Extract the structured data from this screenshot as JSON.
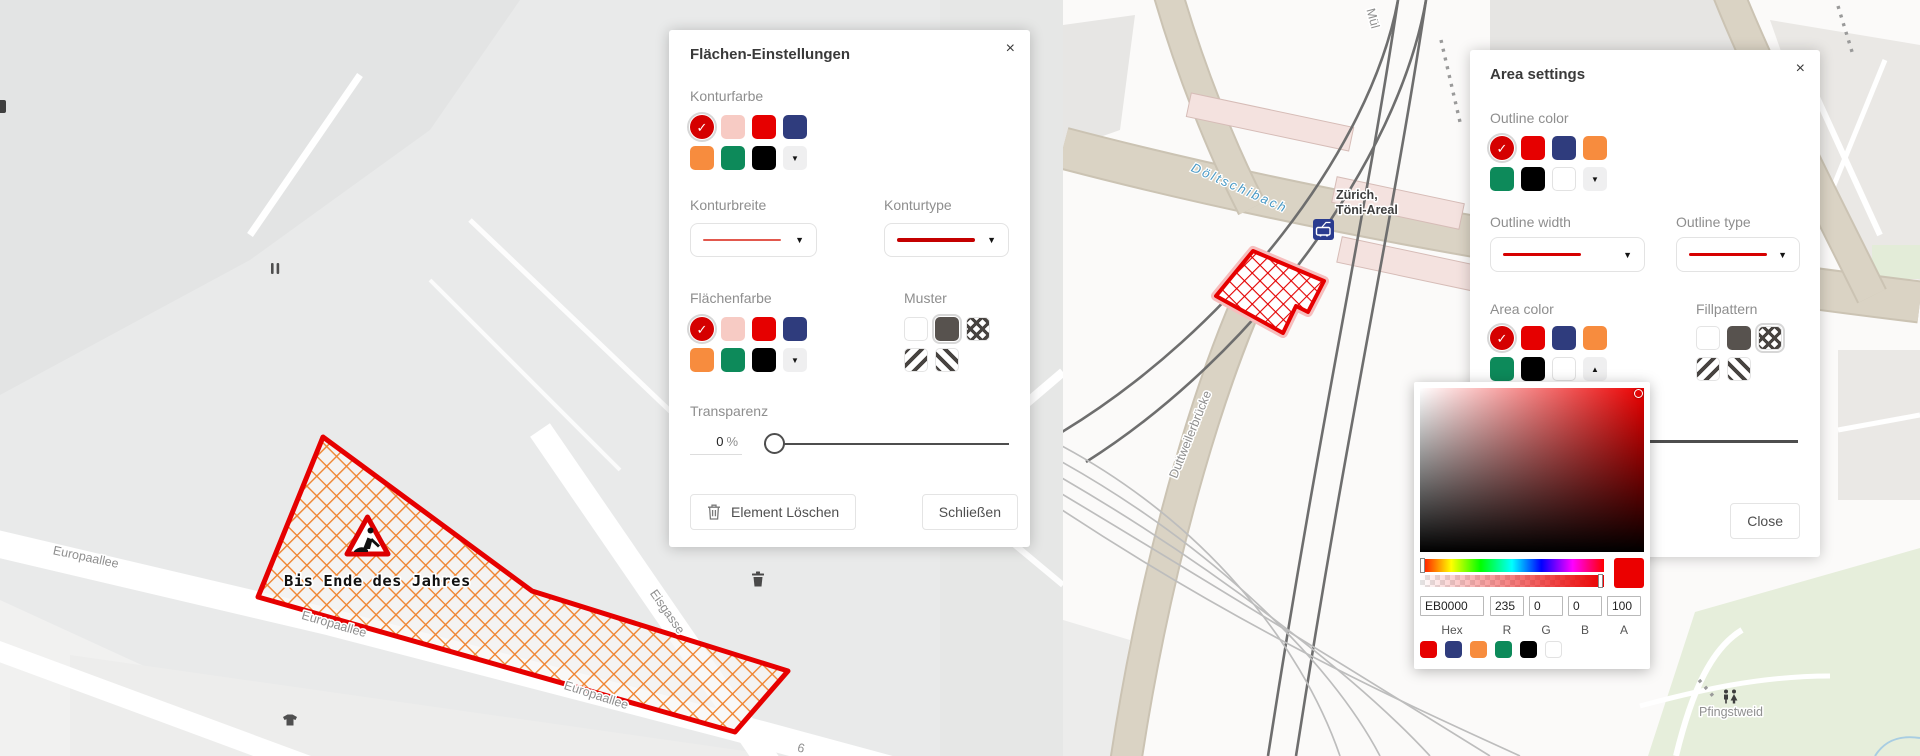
{
  "icons": {
    "close": "×",
    "chevron_down": "▼",
    "chevron_up": "▲",
    "check": "✓"
  },
  "palette": {
    "selected_red": "#d50000",
    "red": "#e60000",
    "pink": "#f7cbc4",
    "navy": "#2f3c7d",
    "orange": "#f78c3e",
    "green": "#0d8a5a",
    "black": "#000000",
    "white": "#ffffff",
    "pattern_dark": "#474340",
    "left_area_hatch": "#ef8430",
    "right_area_hatch": "#e30000",
    "polygon_outline": "#e60000"
  },
  "left_dialog": {
    "title": "Flächen-Einstellungen",
    "outline_color_label": "Konturfarbe",
    "outline_width_label": "Konturbreite",
    "outline_type_label": "Konturtype",
    "area_color_label": "Flächenfarbe",
    "pattern_label": "Muster",
    "transparency_label": "Transparenz",
    "transparency_value": "0",
    "transparency_unit": "%",
    "delete_button_label": "Element Löschen",
    "close_button_label": "Schließen",
    "width_line_color": "#e2584d",
    "type_line_color": "#c40000",
    "outline_swatches": [
      {
        "color": "#d50000",
        "selected": true
      },
      {
        "color": "#f7cbc4"
      },
      {
        "color": "#e60000"
      },
      {
        "color": "#2f3c7d"
      },
      {
        "color": "#f78c3e"
      },
      {
        "color": "#0d8a5a"
      },
      {
        "color": "#000000"
      },
      {
        "type": "dropdown",
        "dir": "down"
      }
    ],
    "area_swatches": [
      {
        "color": "#d50000",
        "selected": true
      },
      {
        "color": "#f7cbc4"
      },
      {
        "color": "#e60000"
      },
      {
        "color": "#2f3c7d"
      },
      {
        "color": "#f78c3e"
      },
      {
        "color": "#0d8a5a"
      },
      {
        "color": "#000000"
      },
      {
        "type": "dropdown",
        "dir": "down"
      }
    ],
    "pattern_swatches": [
      {
        "type": "empty"
      },
      {
        "type": "solid",
        "selected": true
      },
      {
        "type": "cross"
      },
      {
        "type": "diag-a"
      },
      {
        "type": "diag-b"
      }
    ]
  },
  "right_dialog": {
    "title": "Area settings",
    "outline_color_label": "Outline color",
    "outline_width_label": "Outline width",
    "outline_type_label": "Outline type",
    "area_color_label": "Area color",
    "pattern_label": "Fillpattern",
    "close_button_label": "Close",
    "width_line_color": "#d60000",
    "type_line_color": "#d60000",
    "outline_swatches": [
      {
        "color": "#d50000",
        "selected": true
      },
      {
        "color": "#e60000"
      },
      {
        "color": "#2f3c7d"
      },
      {
        "color": "#f78c3e"
      },
      {
        "color": "#0d8a5a"
      },
      {
        "color": "#000000"
      },
      {
        "color": "#ffffff",
        "border": true
      },
      {
        "type": "dropdown",
        "dir": "down"
      }
    ],
    "area_swatches": [
      {
        "color": "#d50000",
        "selected": true
      },
      {
        "color": "#e60000"
      },
      {
        "color": "#2f3c7d"
      },
      {
        "color": "#f78c3e"
      },
      {
        "color": "#0d8a5a"
      },
      {
        "color": "#000000"
      },
      {
        "color": "#ffffff",
        "border": true
      },
      {
        "type": "dropdown",
        "dir": "up"
      }
    ],
    "pattern_swatches": [
      {
        "type": "empty"
      },
      {
        "type": "solid"
      },
      {
        "type": "cross",
        "selected": true
      },
      {
        "type": "diag-a"
      },
      {
        "type": "diag-b"
      }
    ]
  },
  "color_picker": {
    "selected_color": "#EB0000",
    "hex_label": "Hex",
    "hex_value": "EB0000",
    "r_label": "R",
    "r_value": "235",
    "g_label": "G",
    "g_value": "0",
    "b_label": "B",
    "b_value": "0",
    "a_label": "A",
    "a_value": "100",
    "preset_swatches": [
      {
        "color": "#e60000"
      },
      {
        "color": "#2f3c7d"
      },
      {
        "color": "#f78c3e"
      },
      {
        "color": "#0d8a5a"
      },
      {
        "color": "#000000"
      },
      {
        "color": "#ffffff",
        "border": true
      }
    ]
  },
  "left_map": {
    "annotation": "Bis Ende des Jahres",
    "street_label_1": "Europaallee",
    "street_label_2": "Europaallee",
    "street_label_3": "Europaallee",
    "street_label_4": "Eisgasse",
    "house_number": "6"
  },
  "right_map": {
    "stream_label": "Döltschibach",
    "station_label_line1": "Zürich,",
    "station_label_line2": "Töni-Areal",
    "bridge_label": "Duttweilerbrücke",
    "park_label": "Pfingstweid",
    "street_label_top": "Mül"
  }
}
